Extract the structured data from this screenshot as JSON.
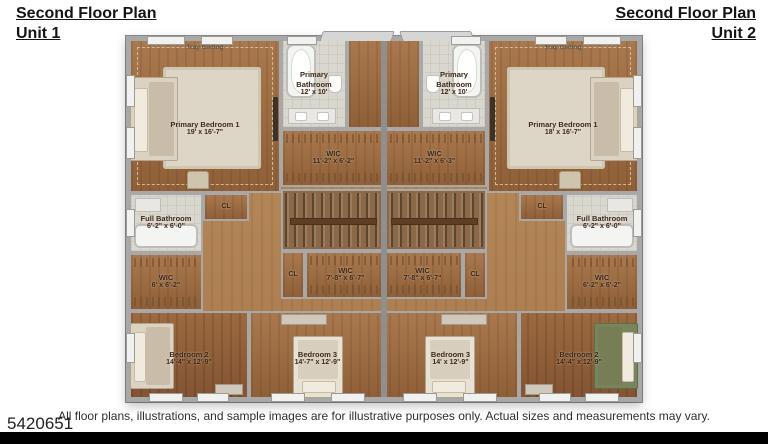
{
  "header": {
    "unit1": {
      "title": "Second Floor Plan",
      "subtitle": "Unit 1"
    },
    "unit2": {
      "title": "Second Floor Plan",
      "subtitle": "Unit 2"
    }
  },
  "plan": {
    "unit1": {
      "tray_ceiling": "Tray Ceiling",
      "primary_bedroom": {
        "name": "Primary Bedroom 1",
        "dims": "19' x 16'-7\""
      },
      "primary_bathroom": {
        "name": "Primary Bathroom",
        "dims": "12' x 10'"
      },
      "wic_primary": {
        "name": "WIC",
        "dims": "11'-2\" x 6'-2\""
      },
      "full_bathroom": {
        "name": "Full Bathroom",
        "dims": "6'-2\" x 6'-0\""
      },
      "closet_upper": "CL",
      "wic_small": {
        "name": "WIC",
        "dims": "6' x 6'-2\""
      },
      "closet_hall": "CL",
      "wic_hall": {
        "name": "WIC",
        "dims": "7'-8\" x 6'-7\""
      },
      "bedroom2": {
        "name": "Bedroom 2",
        "dims": "14'-4\" x 12'-9\""
      },
      "bedroom3": {
        "name": "Bedroom 3",
        "dims": "14'-7\" x 12'-9\""
      }
    },
    "unit2": {
      "tray_ceiling": "Tray Ceiling",
      "primary_bedroom": {
        "name": "Primary Bedroom 1",
        "dims": "18' x 16'-7\""
      },
      "primary_bathroom": {
        "name": "Primary Bathroom",
        "dims": "12' x 10'"
      },
      "wic_primary": {
        "name": "WIC",
        "dims": "11'-2\" x 6'-3\""
      },
      "full_bathroom": {
        "name": "Full Bathroom",
        "dims": "6'-2\" x 6'-0\""
      },
      "closet_upper": "CL",
      "wic_small": {
        "name": "WIC",
        "dims": "6'-2\" x 6'-2\""
      },
      "closet_hall": "CL",
      "wic_hall": {
        "name": "WIC",
        "dims": "7'-8\" x 6'-7\""
      },
      "bedroom2": {
        "name": "Bedroom 2",
        "dims": "14'-4\" x 12'-9\""
      },
      "bedroom3": {
        "name": "Bedroom 3",
        "dims": "14' x 12'-9\""
      }
    }
  },
  "footer": {
    "disclaimer": "All floor plans, illustrations, and sample images are for illustrative purposes only. Actual sizes and measurements may vary.",
    "listing_number": "5420651"
  },
  "colors": {
    "wood_floor": "#a9784e",
    "wood_dark": "#8f6038",
    "tile": "#dad7cf",
    "wall": "#a8a8a8",
    "rug": "#ddd5c6",
    "bed_beige": "#dbd2c2",
    "bed_green": "#77855c",
    "label_text": "#3b2516",
    "bottom_bar": "#000000"
  }
}
